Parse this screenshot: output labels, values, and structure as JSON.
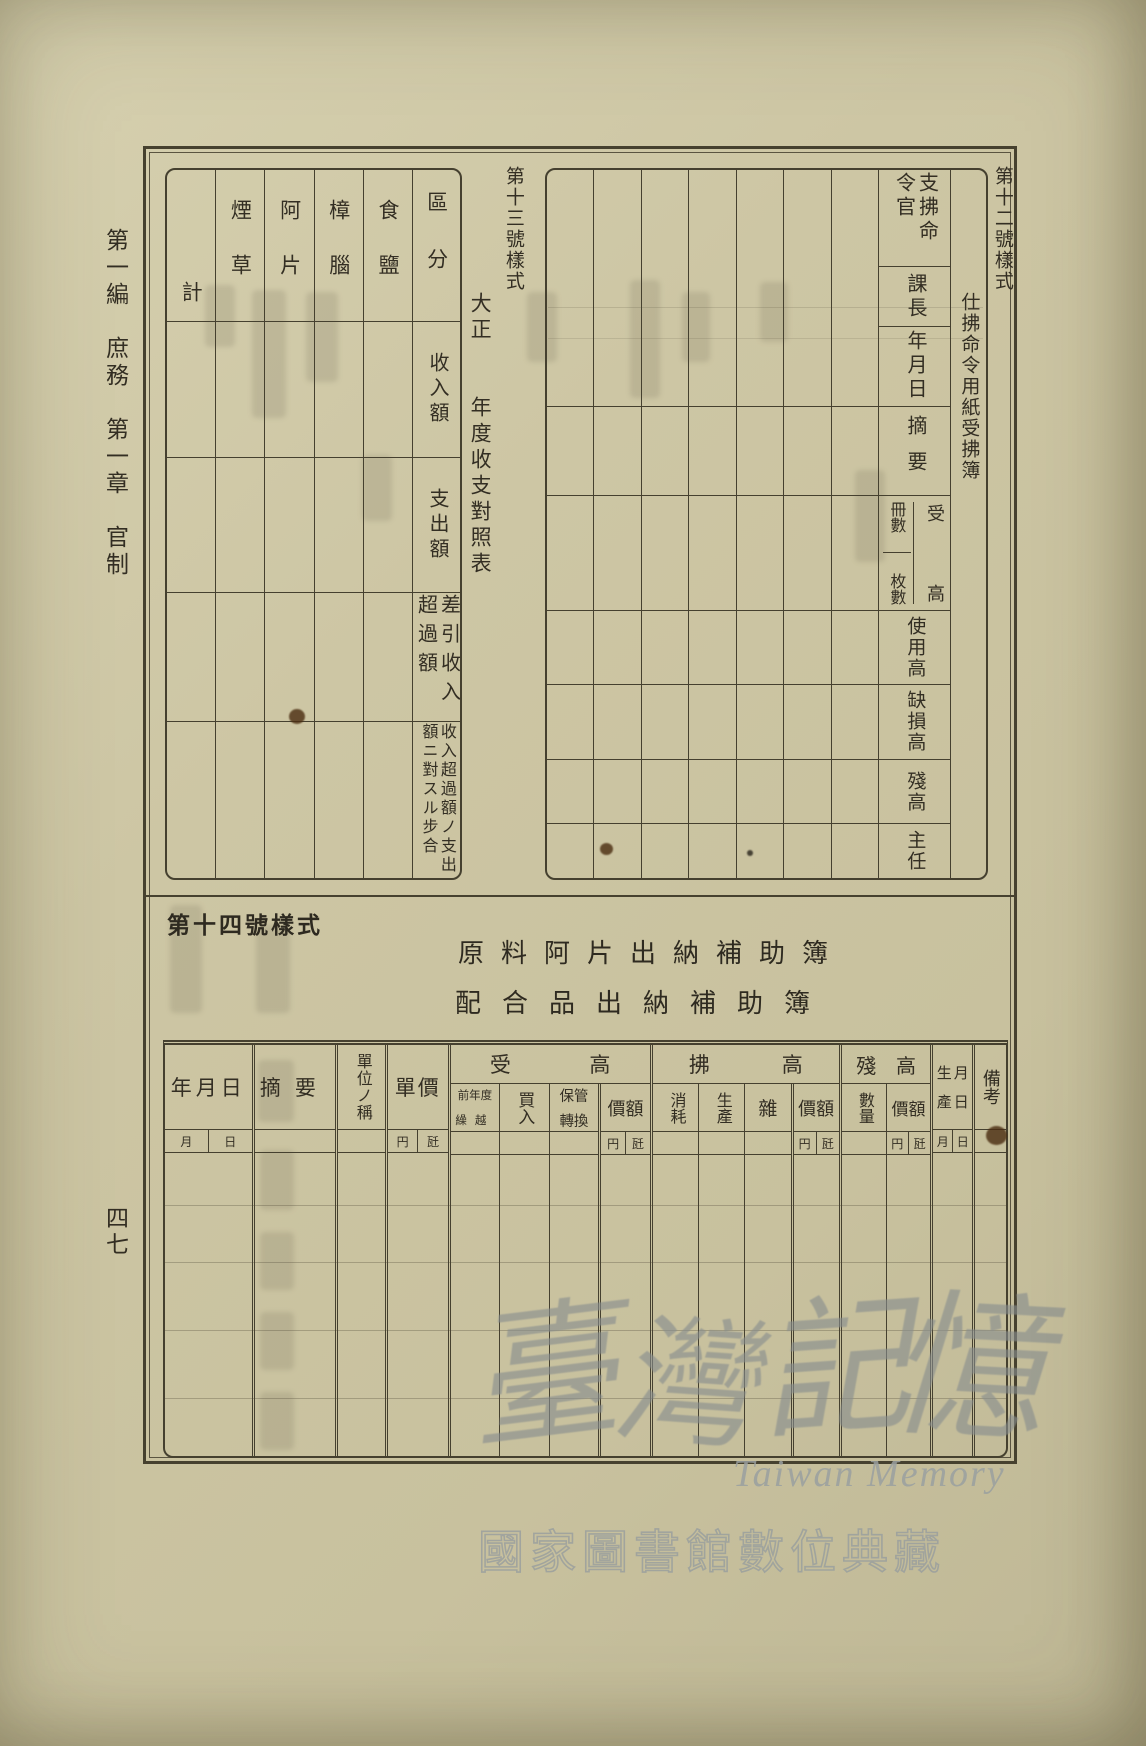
{
  "page": {
    "margin_label": "第一編　庶務　第一章　官制",
    "page_number": "四七"
  },
  "form12": {
    "label": "第十二號樣式",
    "title": "仕拂命令用紙受拂簿",
    "header": {
      "officer": "支拂命令官",
      "section_chief": "課長",
      "date": "年月日",
      "summary": "摘要",
      "receive": "受",
      "high": "高",
      "books": "冊數",
      "sheets": "枚數",
      "used": "使用高",
      "shortage": "缺損高",
      "balance": "殘高",
      "chief": "主任"
    }
  },
  "form13": {
    "label": "第十三號樣式",
    "title": "大正　　年度收支對照表",
    "rows": {
      "category": "區分",
      "income": "收入額",
      "expense": "支出額",
      "net_excess": "差引收入超過額",
      "ratio": "收入超過額ノ支出額ニ對スル步合"
    },
    "categories": [
      "食鹽",
      "樟腦",
      "阿片",
      "煙草",
      "計"
    ]
  },
  "form14": {
    "label": "第十四號樣式",
    "title1": "原料阿片出納補助簿",
    "title2": "配合品出納補助簿",
    "header": {
      "date": "年月日",
      "summary": "摘要",
      "unit_name": "單位ノ稱",
      "unit_price": "單價",
      "receive": "受",
      "pay": "拂",
      "high": "高",
      "balance": "殘　高",
      "prev_year_1": "前年度",
      "prev_year_2": "繰越",
      "purchase": "買入",
      "custody_1": "保管",
      "custody_2": "轉換",
      "value": "價額",
      "consumption": "消耗",
      "production": "生產",
      "misc": "雜",
      "quantity": "數量",
      "prod_date_11": "生",
      "prod_date_12": "月",
      "prod_date_21": "產",
      "prod_date_22": "日",
      "remarks": "備考"
    },
    "units": {
      "month": "月",
      "day": "日",
      "yen": "円",
      "kg": "瓩"
    }
  },
  "watermark": {
    "char1": "臺",
    "char2": "灣",
    "char3": "記",
    "char4": "憶",
    "latin": "Taiwan Memory",
    "library": "國家圖書館數位典藏"
  }
}
